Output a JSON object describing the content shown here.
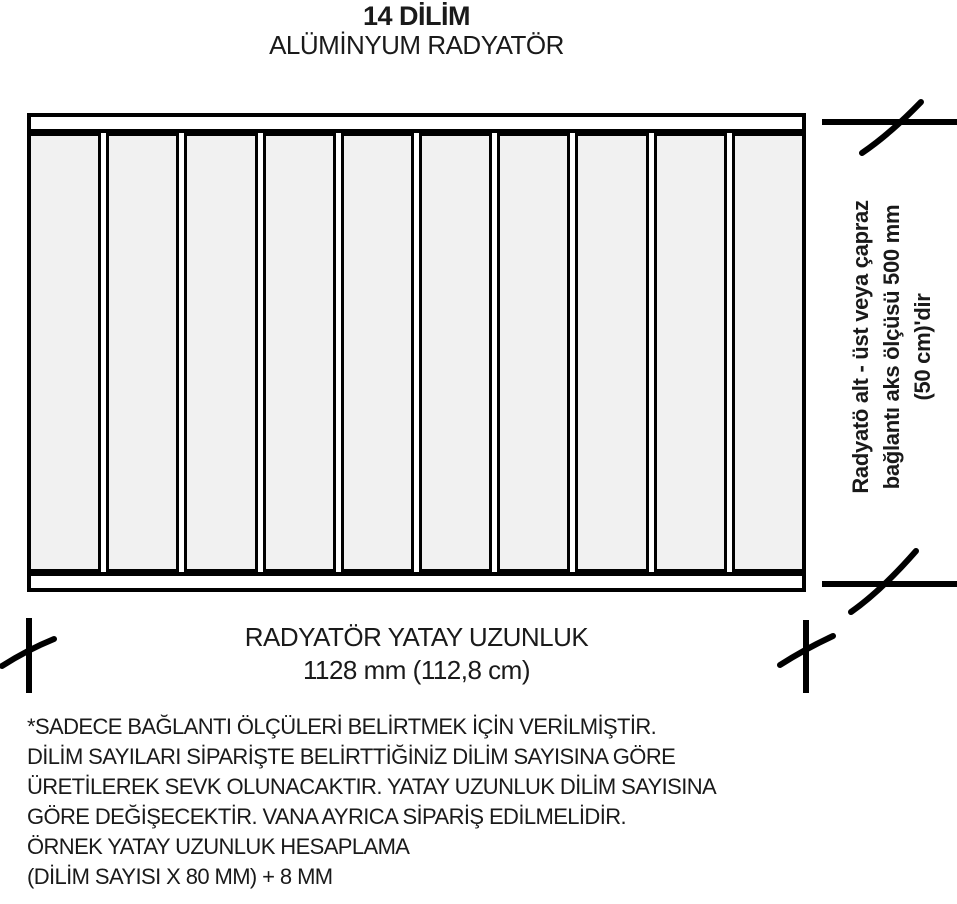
{
  "page": {
    "title_line1": "14 DİLİM",
    "title_line2": "ALÜMİNYUM RADYATÖR"
  },
  "diagram": {
    "sections_shown": 10,
    "sections_total": 14,
    "section_fill": "#f1f1f1",
    "outline_color": "#000000",
    "background_color": "#ffffff",
    "rotated_note_lines": [
      "Radyatö alt - üst veya çapraz",
      "bağlantı aks ölçüsü 500 mm",
      "(50 cm)'dir"
    ],
    "break_marks": [
      "break-mark-top-right-horizontal",
      "break-mark-bottom-right-horizontal",
      "break-mark-bottom-left-vertical",
      "break-mark-bottom-right-vertical"
    ]
  },
  "dimension": {
    "label": "RADYATÖR YATAY UZUNLUK",
    "value": "1128 mm (112,8 cm)"
  },
  "notes": {
    "lines": [
      "*SADECE BAĞLANTI ÖLÇÜLERİ BELİRTMEK İÇİN VERİLMİŞTİR.",
      "DİLİM SAYILARI SİPARİŞTE BELİRTTİĞİNİZ DİLİM SAYISINA GÖRE",
      "ÜRETİLEREK SEVK OLUNACAKTIR. YATAY UZUNLUK DİLİM SAYISINA",
      "GÖRE DEĞİŞECEKTİR. VANA AYRICA SİPARİŞ EDİLMELİDİR.",
      "ÖRNEK YATAY UZUNLUK HESAPLAMA",
      "(DİLİM SAYISI X 80 MM) + 8 MM"
    ]
  }
}
